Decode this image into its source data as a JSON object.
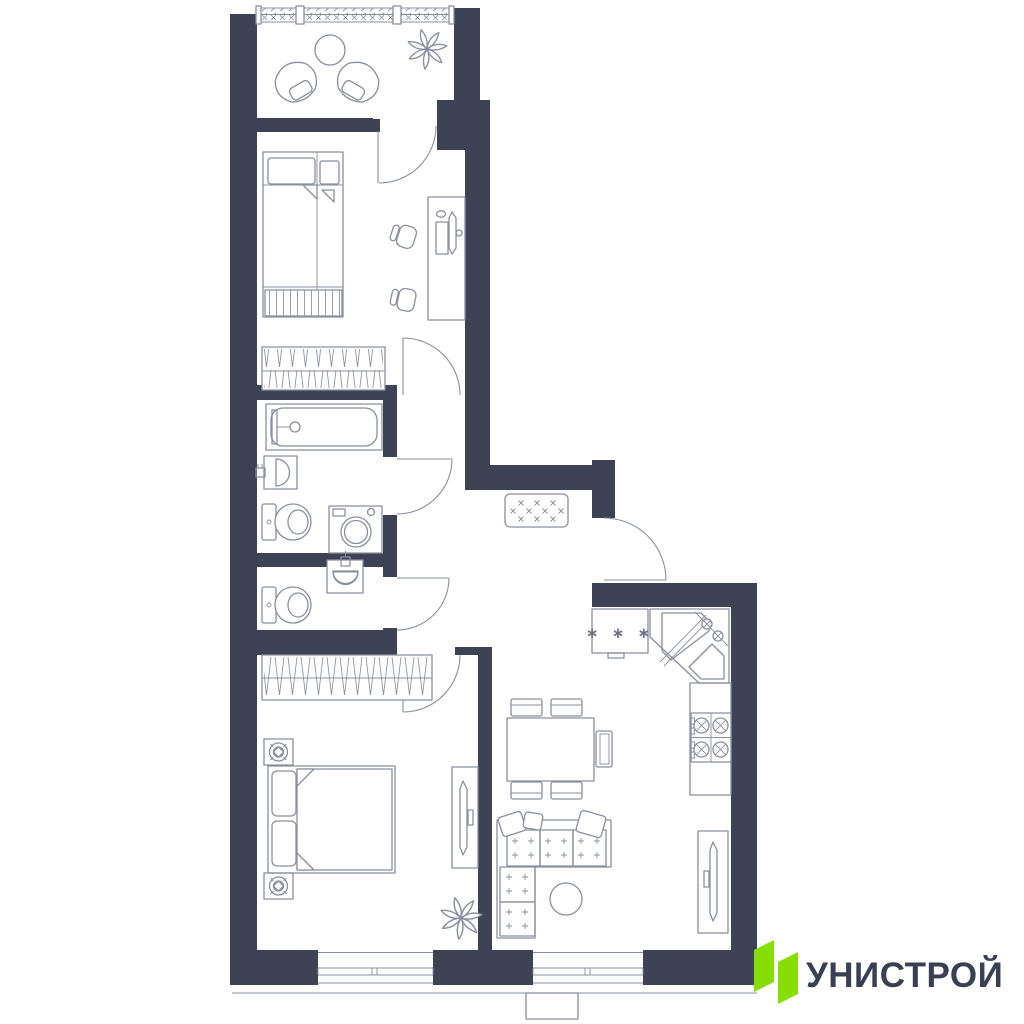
{
  "title": "apartment-floor-plan",
  "colors": {
    "wall": "#3E4255",
    "line": "#8A8FA0",
    "green": "#86DE04",
    "dark": "#3A4053",
    "bg": "#FFFFFF"
  },
  "brand": {
    "name": "УНИСТРОЙ"
  },
  "symbols": {
    "freezer_marks": "∗ ∗ ∗",
    "doormat_mark": "×",
    "sofa_mark": "+"
  },
  "rooms": [
    {
      "name": "balcony",
      "items": [
        "armchair",
        "armchair",
        "round-table",
        "plant"
      ]
    },
    {
      "name": "bedroom-1",
      "items": [
        "single-bed",
        "bedside-shelf",
        "foot-bench",
        "desk",
        "monitor",
        "office-chair",
        "office-chair",
        "wardrobe"
      ]
    },
    {
      "name": "bathroom",
      "items": [
        "bathtub",
        "washbasin",
        "toilet",
        "washing-machine"
      ]
    },
    {
      "name": "wc",
      "items": [
        "washbasin",
        "toilet"
      ]
    },
    {
      "name": "hallway",
      "items": [
        "doormat",
        "entrance-door"
      ]
    },
    {
      "name": "kitchen-living-room",
      "items": [
        "fridge-freezer",
        "corner-sink",
        "cooktop",
        "kitchen-counter",
        "dining-table",
        "chair",
        "chair",
        "chair",
        "chair",
        "chair",
        "corner-sofa",
        "coffee-table",
        "tv-console"
      ]
    },
    {
      "name": "bedroom-2",
      "items": [
        "double-bed",
        "nightstand-with-lamp",
        "nightstand-with-lamp",
        "wardrobe",
        "tv-console",
        "plant"
      ]
    }
  ]
}
